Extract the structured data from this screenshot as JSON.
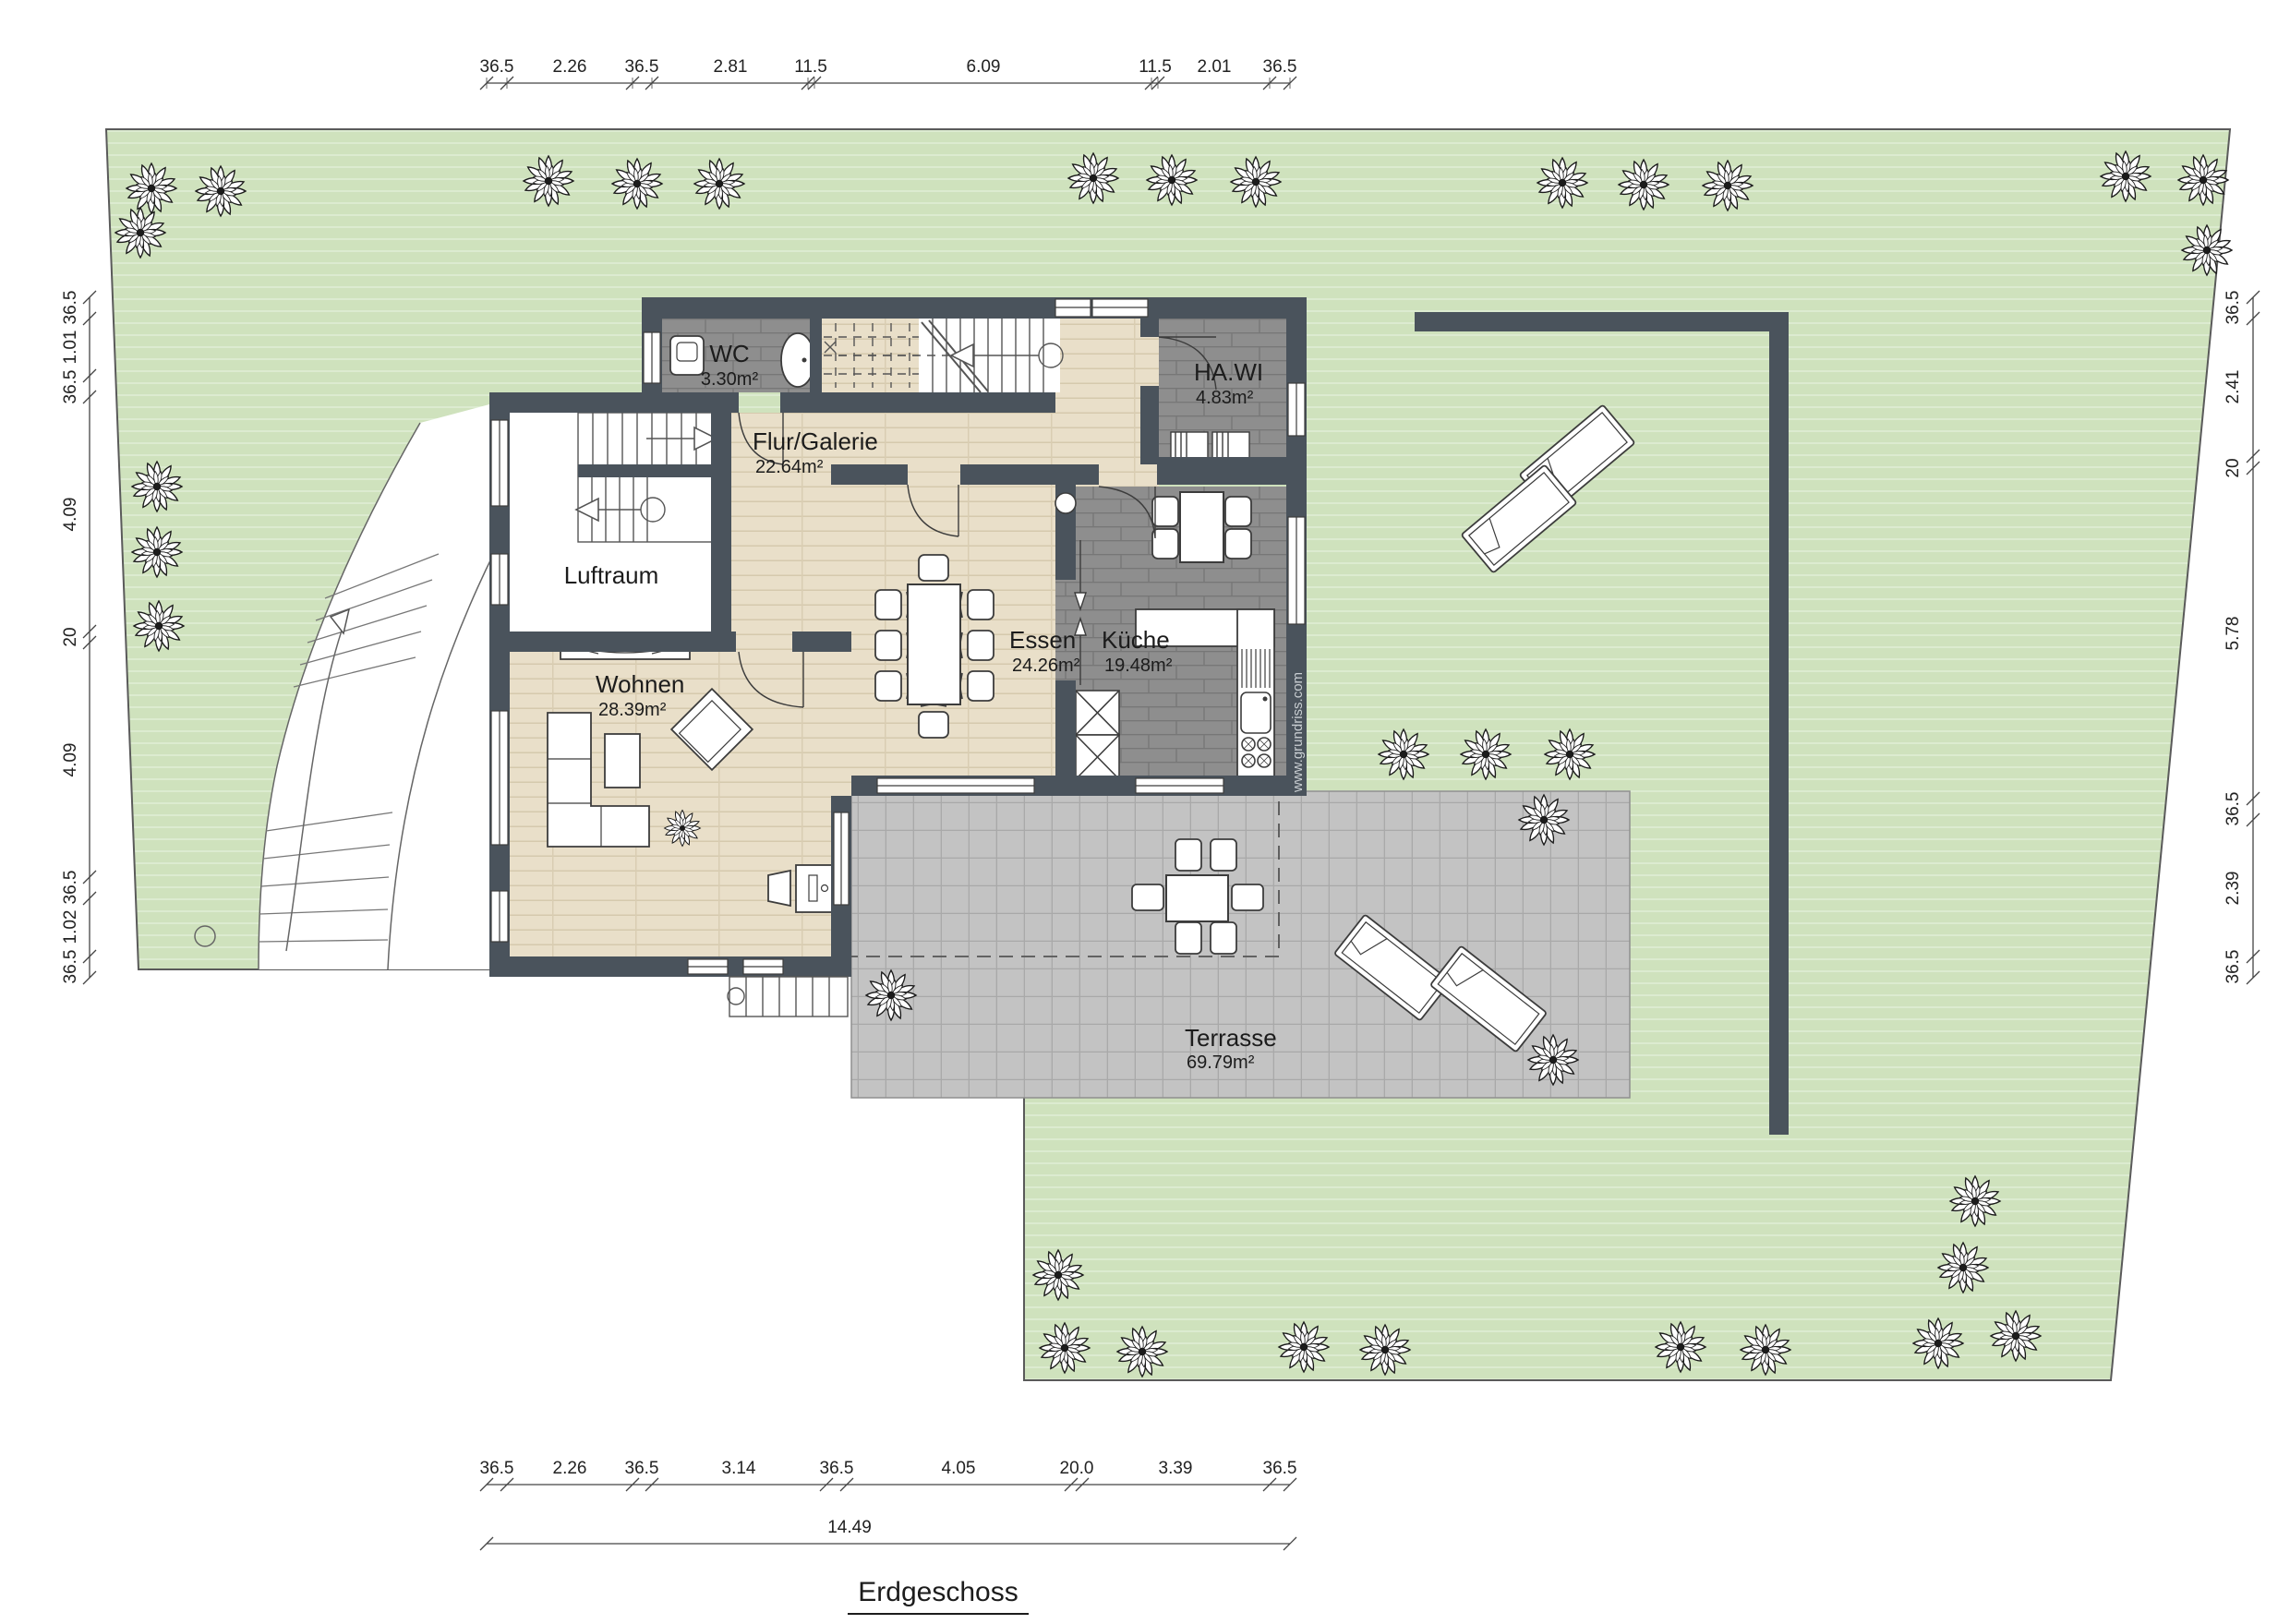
{
  "plan": {
    "title": "Erdgeschoss",
    "watermark": "www.grundriss.com",
    "total_width": "14.49"
  },
  "rooms": {
    "wc": {
      "name": "WC",
      "area": "3.30m²"
    },
    "flur": {
      "name": "Flur/Galerie",
      "area": "22.64m²"
    },
    "hawi": {
      "name": "HA.WI",
      "area": "4.83m²"
    },
    "luftraum": {
      "name": "Luftraum"
    },
    "wohnen": {
      "name": "Wohnen",
      "area": "28.39m²"
    },
    "essen": {
      "name": "Essen",
      "area": "24.26m²"
    },
    "kueche": {
      "name": "Küche",
      "area": "19.48m²"
    },
    "terrasse": {
      "name": "Terrasse",
      "area": "69.79m²"
    }
  },
  "dims": {
    "top": [
      "36.5",
      "2.26",
      "36.5",
      "2.81",
      "11.5",
      "6.09",
      "11.5",
      "2.01",
      "36.5"
    ],
    "bottom": [
      "36.5",
      "2.26",
      "36.5",
      "3.14",
      "36.5",
      "4.05",
      "20.0",
      "3.39",
      "36.5"
    ],
    "left": [
      "36.5",
      "1.01",
      "36.5",
      "4.09",
      "20",
      "4.09",
      "36.5",
      "1.02",
      "36.5"
    ],
    "right": [
      "36.5",
      "2.41",
      "20",
      "5.78",
      "36.5",
      "2.39",
      "36.5"
    ]
  },
  "colors": {
    "wall": "#4a535c",
    "garden": "#cfe2bd",
    "terrace": "#c3c3c3",
    "tile": "#8e8e8e",
    "wood": "#e9dfc9"
  }
}
